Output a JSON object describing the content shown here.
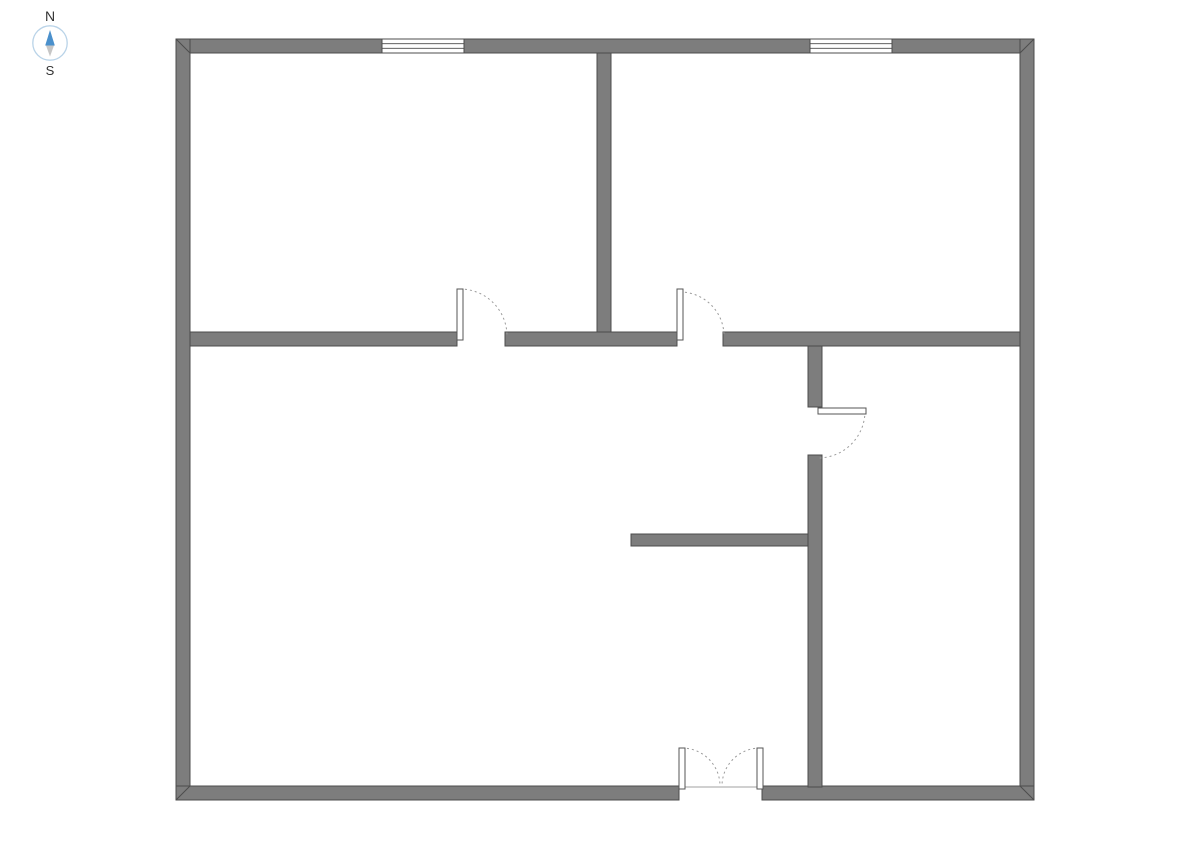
{
  "compass": {
    "north_label": "N",
    "south_label": "S",
    "ring_color": "#b9d3e8",
    "needle_north_color": "#4a90cc",
    "needle_south_color": "#c6c6c6"
  },
  "floorplan": {
    "wall_fill": "#7d7d7d",
    "wall_stroke": "#4c4c4c",
    "window_fill": "#ffffff",
    "door_leaf_fill": "#ffffff",
    "door_leaf_stroke": "#555555",
    "door_arc_color": "#9a9a9a",
    "threshold_color": "#a0a0a0",
    "walls": [
      {
        "name": "wall-exterior-top",
        "x": 176,
        "y": 39,
        "w": 858,
        "h": 14
      },
      {
        "name": "wall-exterior-left",
        "x": 176,
        "y": 39,
        "w": 14,
        "h": 761
      },
      {
        "name": "wall-exterior-right",
        "x": 1020,
        "y": 39,
        "w": 14,
        "h": 761
      },
      {
        "name": "wall-exterior-bottom-left",
        "x": 176,
        "y": 786,
        "w": 503,
        "h": 14
      },
      {
        "name": "wall-exterior-bottom-right",
        "x": 762,
        "y": 786,
        "w": 272,
        "h": 14
      },
      {
        "name": "wall-interior-top-rooms-divider",
        "x": 597,
        "y": 53,
        "w": 14,
        "h": 279
      },
      {
        "name": "wall-interior-mid-left",
        "x": 190,
        "y": 332,
        "w": 267,
        "h": 14
      },
      {
        "name": "wall-interior-mid-center",
        "x": 505,
        "y": 332,
        "w": 172,
        "h": 14
      },
      {
        "name": "wall-interior-mid-right",
        "x": 723,
        "y": 332,
        "w": 297,
        "h": 14
      },
      {
        "name": "wall-interior-right-upper",
        "x": 808,
        "y": 346,
        "w": 14,
        "h": 61
      },
      {
        "name": "wall-interior-right-lower",
        "x": 808,
        "y": 455,
        "w": 14,
        "h": 332
      },
      {
        "name": "wall-interior-partial",
        "x": 631,
        "y": 534,
        "w": 177,
        "h": 12
      }
    ],
    "corner_miters": [
      [
        176,
        39,
        190,
        53
      ],
      [
        1034,
        39,
        1020,
        53
      ],
      [
        176,
        800,
        190,
        786
      ],
      [
        1034,
        800,
        1020,
        786
      ]
    ],
    "windows": [
      {
        "name": "window-top-left",
        "x": 382,
        "y": 39,
        "w": 82,
        "h": 14
      },
      {
        "name": "window-top-right",
        "x": 810,
        "y": 39,
        "w": 82,
        "h": 14
      }
    ],
    "doors": [
      {
        "name": "door-top-left-room",
        "leaf": {
          "x": 457,
          "y": 289,
          "w": 6,
          "h": 51
        },
        "arc": {
          "r": 47,
          "from": [
            460,
            289
          ],
          "to": [
            507,
            336
          ],
          "sweep": 1
        }
      },
      {
        "name": "door-top-right-room",
        "leaf": {
          "x": 677,
          "y": 289,
          "w": 6,
          "h": 51
        },
        "arc": {
          "r": 44,
          "from": [
            680,
            292
          ],
          "to": [
            724,
            336
          ],
          "sweep": 1
        }
      },
      {
        "name": "door-right-room",
        "leaf": {
          "x": 818,
          "y": 408,
          "w": 48,
          "h": 6
        },
        "arc": {
          "r": 47,
          "from": [
            865,
            411
          ],
          "to": [
            818,
            458
          ],
          "sweep": 1
        }
      },
      {
        "name": "double-door-entry-left",
        "leaf": {
          "x": 679,
          "y": 748,
          "w": 6,
          "h": 41
        },
        "arc": {
          "r": 38,
          "from": [
            682,
            748
          ],
          "to": [
            720,
            786
          ],
          "sweep": 1
        }
      },
      {
        "name": "double-door-entry-right",
        "leaf": {
          "x": 757,
          "y": 748,
          "w": 6,
          "h": 41
        },
        "arc": {
          "r": 38,
          "from": [
            760,
            748
          ],
          "to": [
            722,
            786
          ],
          "sweep": 0
        }
      }
    ],
    "thresholds": [
      [
        683,
        787,
        757,
        787
      ]
    ]
  }
}
